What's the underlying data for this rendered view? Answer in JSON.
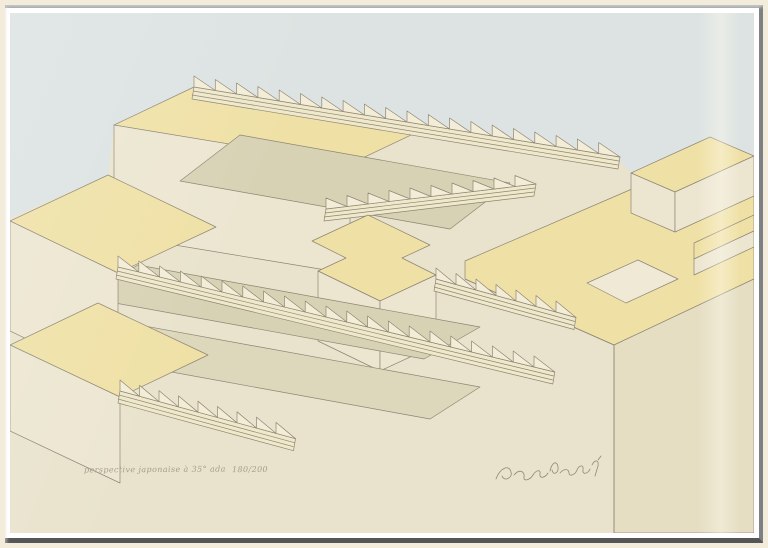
{
  "artwork": {
    "kind": "framed geometric screenprint photograph",
    "subject": "interlocking stepped terraces and long staircases drawn in axonometric (Japanese) perspective",
    "inscriptions": {
      "title_inscription": "perspective japonaise à 35° ada",
      "edition_number": "180/200",
      "signature": "illegible cursive pencil artist signature"
    },
    "frame": {
      "style": "thin silver aluminium frame with warm white inner lip",
      "light_edge_color": "#b8bbbc",
      "dark_edge_color": "#54575a",
      "lip_color": "#f3ecda"
    },
    "palette": {
      "sky_background": "#dce3e2",
      "paper_margin": "#e9e3cd",
      "terrace_top_faces": "#efe1a6",
      "wall_faces": "#ece6d1",
      "shaded_courtyards": "#d8d2b5",
      "stair_treads": "#f3edd7",
      "outline": "#8d8574"
    }
  }
}
